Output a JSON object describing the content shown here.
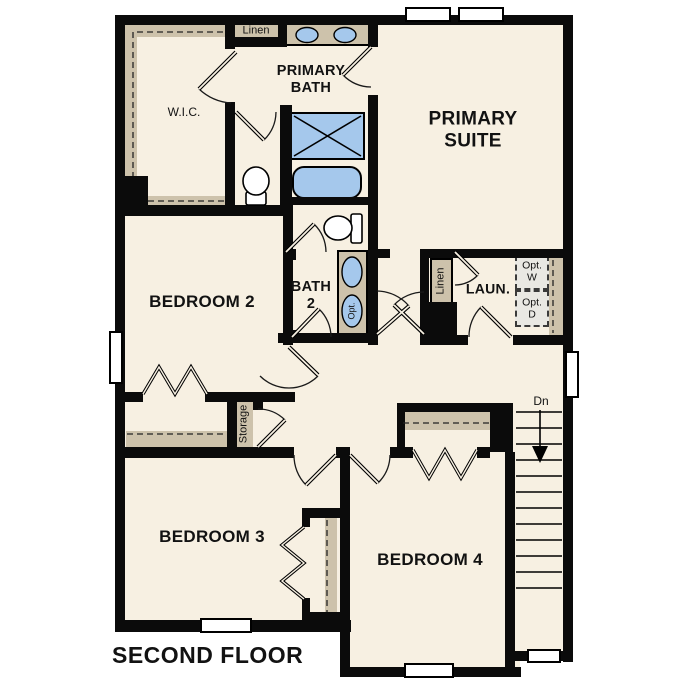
{
  "page": {
    "title": "SECOND FLOOR"
  },
  "colors": {
    "wall": "#0b0b0b",
    "floor": "#f7f0e2",
    "tan": "#cdc2ab",
    "gray": "#e9e8e3",
    "blue": "#a5c8ec"
  },
  "rooms": {
    "wic": "W.I.C.",
    "linen_top": "Linen",
    "primary_bath_1": "PRIMARY",
    "primary_bath_2": "BATH",
    "primary_suite_1": "PRIMARY",
    "primary_suite_2": "SUITE",
    "bedroom2": "BEDROOM 2",
    "bath2_1": "BATH",
    "bath2_2": "2",
    "laundry": "LAUN.",
    "linen_laundry": "Linen",
    "storage": "Storage",
    "bedroom3": "BEDROOM 3",
    "bedroom4": "BEDROOM 4"
  },
  "annotations": {
    "opt_washer_1": "Opt.",
    "opt_washer_2": "W",
    "opt_dryer_1": "Opt.",
    "opt_dryer_2": "D",
    "opt_sink": "Opt.",
    "stairs_down": "Dn"
  }
}
